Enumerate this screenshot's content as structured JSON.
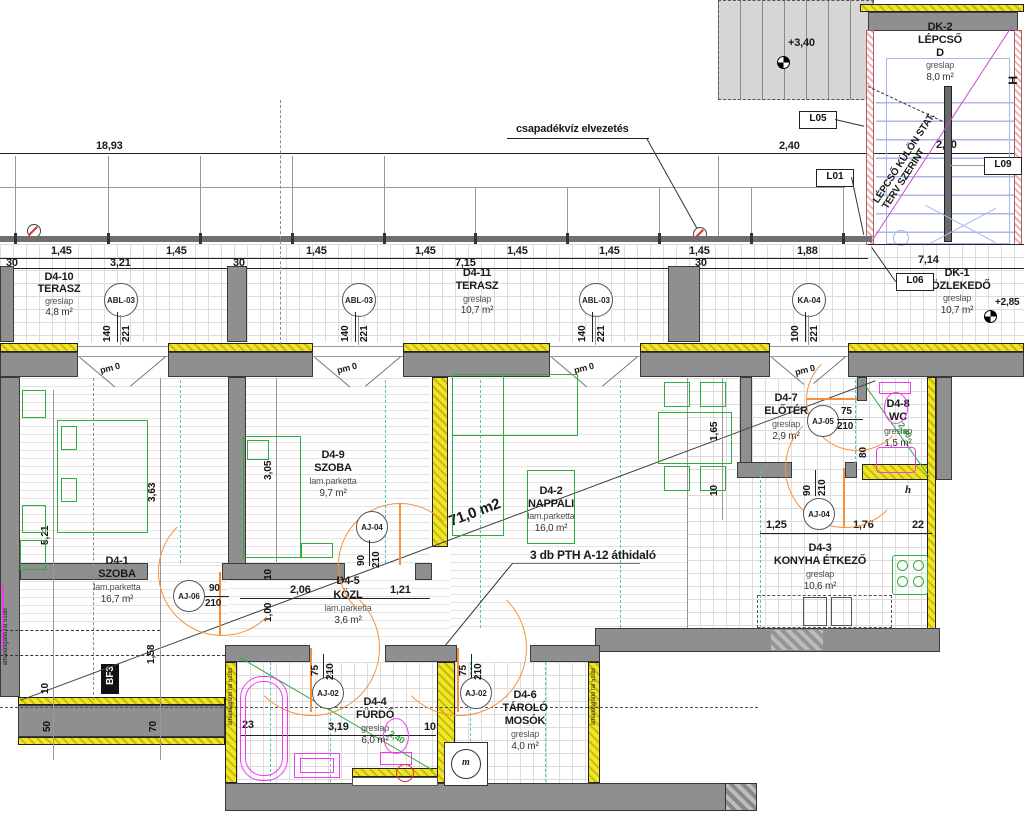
{
  "rooms": [
    {
      "id": "D4-10",
      "name": "TERASZ",
      "finish": "greslap",
      "area": "4,8 m²"
    },
    {
      "id": "D4-11",
      "name": "TERASZ",
      "finish": "greslap",
      "area": "10,7 m²"
    },
    {
      "id": "DK-1",
      "name": "KÖZLEKEDŐ",
      "finish": "greslap",
      "area": "10,7 m²"
    },
    {
      "id": "DK-2",
      "name": "LÉPCSŐ",
      "name2": "D",
      "finish": "greslap",
      "area": "8,0 m²"
    },
    {
      "id": "D4-1",
      "name": "SZOBA",
      "finish": "lam.parketta",
      "area": "16,7 m²"
    },
    {
      "id": "D4-9",
      "name": "SZOBA",
      "finish": "lam.parketta",
      "area": "9,7 m²"
    },
    {
      "id": "D4-2",
      "name": "NAPPALI",
      "finish": "lam.parketta",
      "area": "16,0 m²"
    },
    {
      "id": "D4-5",
      "name": "KÖZL",
      "finish": "lam.parketta",
      "area": "3,6 m²"
    },
    {
      "id": "D4-7",
      "name": "ELŐTÉR",
      "finish": "greslap",
      "area": "2,9 m²"
    },
    {
      "id": "D4-8",
      "name": "WC",
      "finish": "greslap",
      "area": "1,5 m²"
    },
    {
      "id": "D4-3",
      "name": "KONYHA ÉTKEZŐ",
      "finish": "greslap",
      "area": "10,6 m²"
    },
    {
      "id": "D4-4",
      "name": "FÜRDŐ",
      "finish": "greslap",
      "area": "6,0 m²"
    },
    {
      "id": "D4-6",
      "name": "TÁROLÓ",
      "name2": "MOSÓK",
      "finish": "greslap",
      "area": "4,0 m²"
    }
  ],
  "tags": {
    "abl": {
      "label": "ABL-03",
      "w": "140",
      "h": "221"
    },
    "ka": {
      "label": "KA-04",
      "w": "100",
      "h": "221"
    },
    "aj06": {
      "label": "AJ-06",
      "w": "90",
      "h": "210"
    },
    "aj04": {
      "label": "AJ-04",
      "w": "90",
      "h": "210"
    },
    "aj05": {
      "label": "AJ-05",
      "w": "75",
      "h": "210"
    },
    "aj02": {
      "label": "AJ-02",
      "w": "75",
      "h": "210"
    }
  },
  "dims": {
    "total": "18,93",
    "d240": "2,40",
    "d230": "2,30",
    "d145": "1,45",
    "d188": "1,88",
    "d30": "30",
    "d321": "3,21",
    "d715": "7,15",
    "d714": "7,14",
    "d363": "3,63",
    "d521": "5,21",
    "d305": "3,05",
    "d165": "1,65",
    "d10": "10",
    "d206": "2,06",
    "d121": "1,21",
    "d100": "1,00",
    "d158": "1,58",
    "d50": "50",
    "d70": "70",
    "d125": "1,25",
    "d176": "1,76",
    "d22": "22",
    "d80": "80",
    "d23": "23",
    "d319": "3,19"
  },
  "labels": {
    "l05": "L05",
    "l01": "L01",
    "l06": "L06",
    "l09": "L09",
    "bf3": "BF3",
    "h_section": "H",
    "h_small": "h",
    "m_machine": "m"
  },
  "annotations": {
    "rainwater": "csapadékvíz elvezetés",
    "lintel": "3 db PTH A-12 áthidaló",
    "stair_note1": "LÉPCSŐ KÜLÖN STAT.",
    "stair_note2": "TERV SZERINT",
    "total_area": "71,0 m2",
    "lvl340": "+3,40",
    "lvl285": "+2,85",
    "pm0": "pm 0",
    "ceiling240": "2,40",
    "acoustic_wall": "áthallásgátló fal 51dB"
  },
  "colors": {
    "wall": "#8f8f8f",
    "insulation": "#efe32b",
    "furniture": "#2fae3e",
    "fixture": "#f03cf0",
    "door": "#f5913c",
    "stair_blue": "#aab7e8",
    "axis_teal": "#49c8b8",
    "stair_diag": "#c84ac8"
  }
}
